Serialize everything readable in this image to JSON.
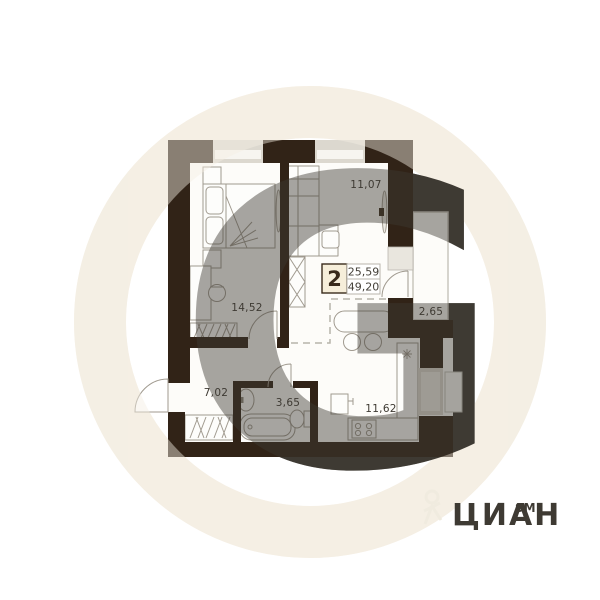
{
  "badge": {
    "rooms_count": "2",
    "area_living": "25,59",
    "area_total": "49,20"
  },
  "rooms": {
    "living": {
      "label": "11,07"
    },
    "bedroom": {
      "label": "14,52"
    },
    "balcony": {
      "label": "2,65"
    },
    "hallway": {
      "label": "7,02"
    },
    "bathroom": {
      "label": "3,65"
    },
    "kitchen": {
      "label": "11,62"
    }
  },
  "watermark": {
    "letter": "G",
    "brand_word": "ЦИАН",
    "brand_mark": "SM"
  },
  "icons": {
    "kitchen_sink": "sink-star",
    "stove": "stove-burners"
  },
  "colors": {
    "wall": "#312317",
    "window": "#dcd8cf",
    "window_inner": "#f7f5f0",
    "sill": "#e9e6de",
    "floor": "#fdfcf9",
    "furniture_stroke": "#a09a8f",
    "badge_fill": "#f6eeda",
    "badge_border": "#3a2b1c",
    "cell_border": "#b9b5ac",
    "dashed": "#b7b3aa",
    "watermark_cream": "#f5efe4",
    "label_text": "#3e3a33"
  }
}
